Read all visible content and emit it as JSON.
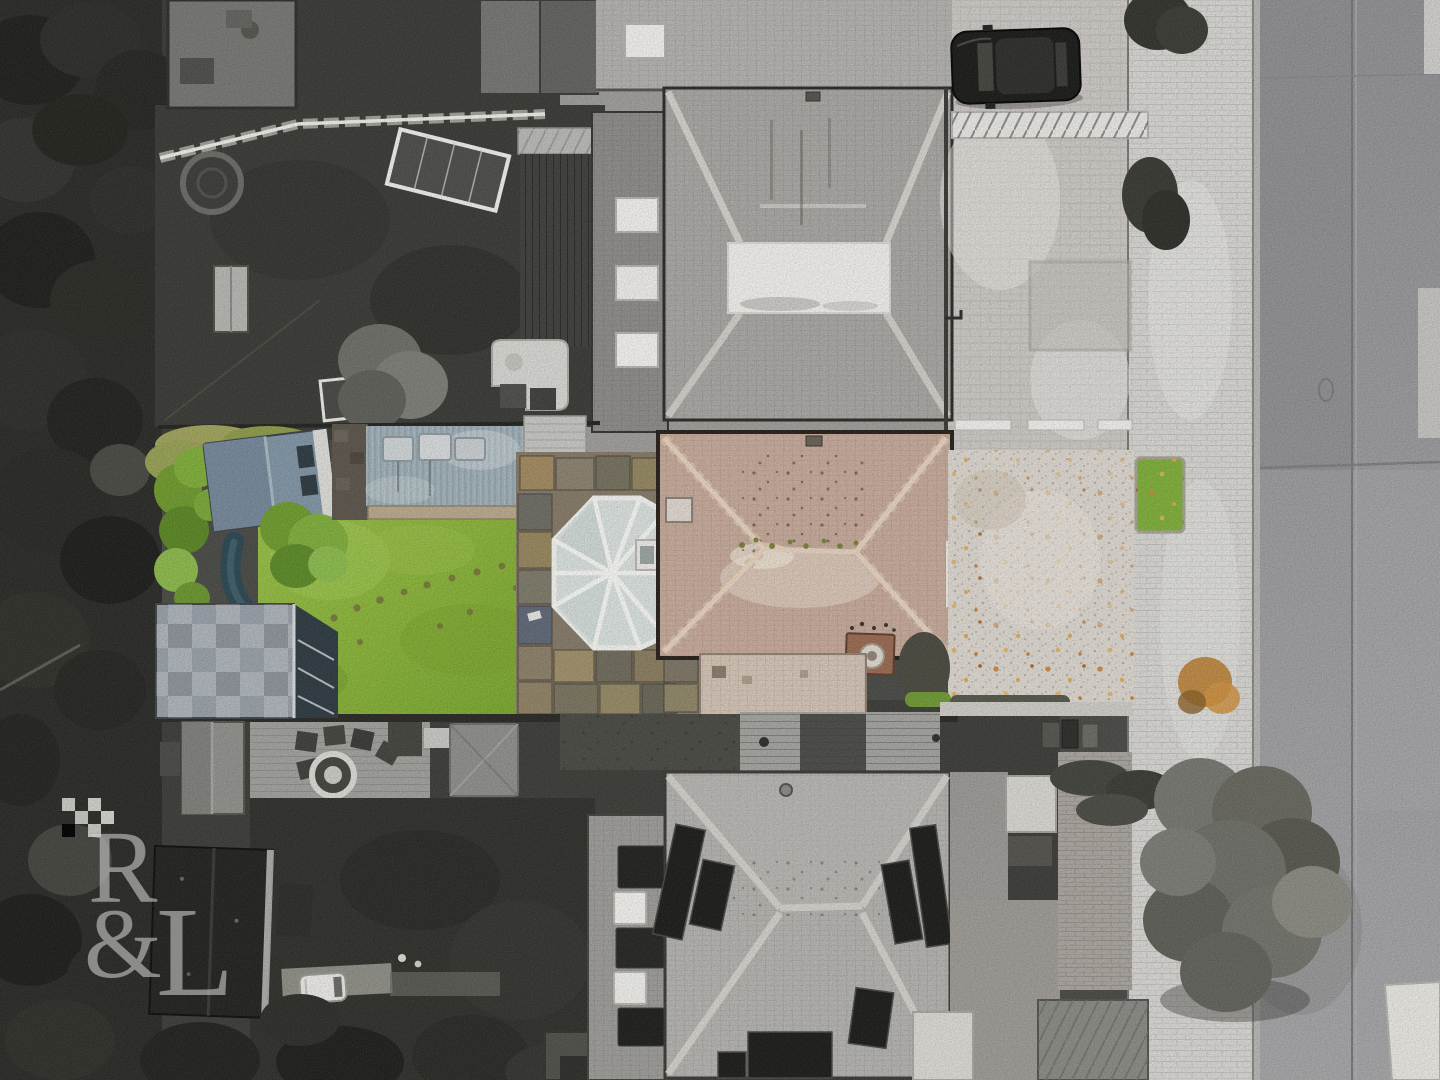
{
  "watermark": {
    "letter1": "R",
    "letter2": "&",
    "letter3": "L"
  },
  "palette": {
    "lawn_green": "#8fb83e",
    "bush_green": "#6f9a2e",
    "subject_roof_tan": "#c6aa9b",
    "shed_blue_gray": "#8195a5",
    "conservatory_glass": "#d9e0de",
    "gravel_light": "#dcd7cf",
    "autumn_leaves_orange": "#c9853c",
    "neighbor_roof_gray": "#a9a7a3",
    "solar_panel_dark": "#1d1d1b",
    "sidewalk_pale": "#d7d6d3",
    "road_gray": "#98989b",
    "tree_dark": "#2b2b28"
  }
}
